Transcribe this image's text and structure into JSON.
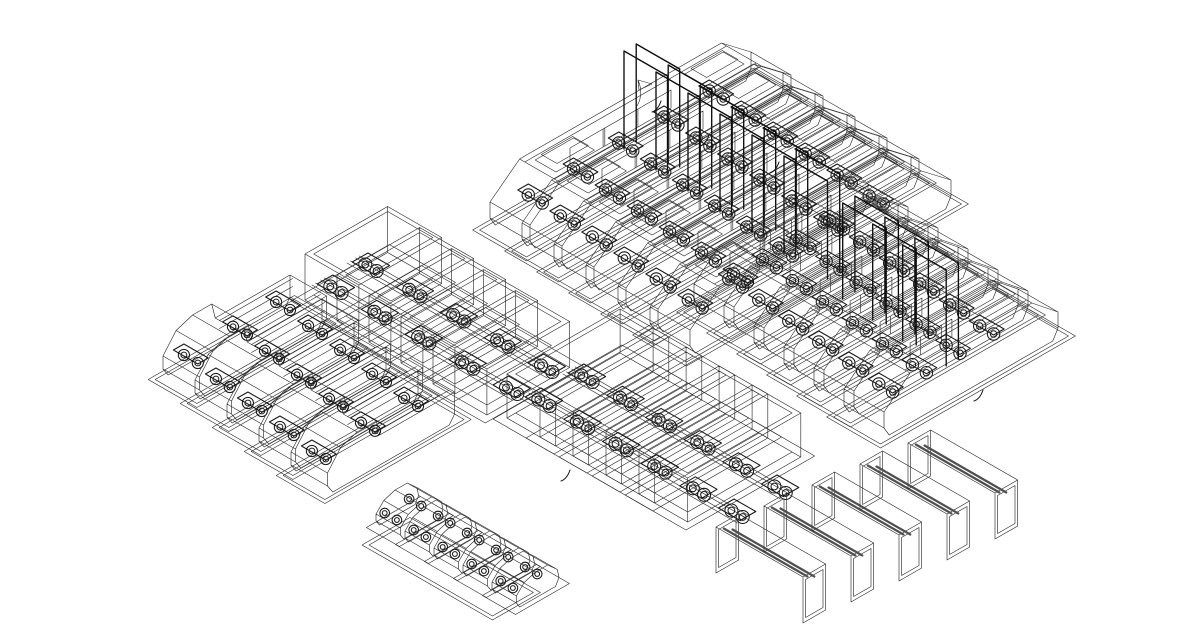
{
  "meta": {
    "description": "Isometric black-and-white CAD wireframe drawing: rows of double-ended tram/bus bodies, open chassis crates threaded by wheel-set rails, delivery vans, small car chassis on a base strip, and portal bench frames",
    "background": "#ffffff",
    "canvas": {
      "width": 1200,
      "height": 630
    }
  },
  "style": {
    "wire_color": "#2d2d2d",
    "accent_color": "#191919",
    "panel_color": "#0d0d0d",
    "band_color": "#4f4f4f"
  },
  "projection": {
    "eu": [
      0.87,
      -0.5
    ],
    "ev": [
      0.87,
      0.5
    ]
  },
  "groups": [
    {
      "id": "tram-row-upper",
      "type": "tram",
      "count": 6,
      "anchor": [
        490,
        228
      ],
      "step": [
        32,
        21
      ],
      "dims": {
        "L": 300,
        "W": 46,
        "H": 52,
        "S": 34
      },
      "wheel_stations": 5,
      "panels": true
    },
    {
      "id": "tram-row-right",
      "type": "tram",
      "count": 6,
      "anchor": [
        694,
        310
      ],
      "step": [
        30,
        21
      ],
      "dims": {
        "L": 200,
        "W": 46,
        "H": 50,
        "S": 30
      },
      "wheel_stations": 4,
      "panels": [
        2,
        3,
        4
      ]
    },
    {
      "id": "crate-row-left",
      "type": "crate",
      "count": 5,
      "anchor": [
        305,
        300
      ],
      "step": [
        32,
        21
      ],
      "dims": {
        "L": 95,
        "W": 62,
        "H": 46
      },
      "bands": [
        {
          "start": [
            312,
            295
          ],
          "len": 230,
          "stations": 5
        },
        {
          "start": [
            347,
            273
          ],
          "len": 230,
          "stations": 5
        }
      ]
    },
    {
      "id": "crate-row-center",
      "type": "crate",
      "count": 5,
      "anchor": [
        507,
        418
      ],
      "step": [
        33,
        19
      ],
      "dims": {
        "L": 130,
        "W": 56,
        "H": 44
      },
      "bands": [
        {
          "start": [
            520,
            408
          ],
          "len": 250,
          "stations": 6
        },
        {
          "start": [
            563,
            384
          ],
          "len": 250,
          "stations": 6
        }
      ]
    },
    {
      "id": "van-row",
      "type": "van",
      "count": 5,
      "anchor": [
        163,
        378
      ],
      "step": [
        32,
        24
      ],
      "dims": {
        "L": 150,
        "W": 42,
        "H": 46
      },
      "wheel_stations": 3
    },
    {
      "id": "car-row",
      "type": "car",
      "count": 5,
      "anchor": [
        376,
        527
      ],
      "step": [
        29,
        17
      ],
      "dims": {
        "L": 50,
        "W": 28
      },
      "strip": {
        "origin": [
          362,
          545
        ],
        "width_u": 55,
        "len_v": 150
      }
    },
    {
      "id": "bench-row",
      "type": "bench",
      "count": 5,
      "anchor": [
        716,
        527
      ],
      "step": [
        48,
        -21
      ],
      "dims": {
        "frame_w": 26,
        "frame_h": 46,
        "len": 100
      }
    },
    {
      "id": "annotation-marks",
      "type": "marks",
      "flag": [
        637,
        80
      ],
      "arcs": [
        [
          652,
          112
        ],
        [
          700,
          146
        ],
        [
          770,
          173
        ],
        [
          974,
          401
        ],
        [
          561,
          481
        ]
      ]
    }
  ]
}
